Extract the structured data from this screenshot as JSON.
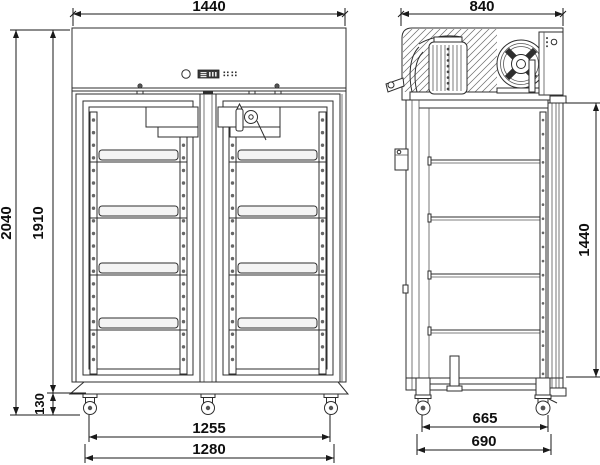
{
  "dimensions": {
    "front_width": "1440",
    "side_depth": "840",
    "overall_height": "2040",
    "body_height": "1910",
    "caster_height": "130",
    "front_caster_span": "1255",
    "front_base_width": "1280",
    "side_door_height": "1440",
    "side_caster_span": "665",
    "side_base_depth": "690"
  },
  "colors": {
    "line": "#2e2e2e",
    "dimension_line": "#1a1a1a",
    "text": "#0f0f0f",
    "background": "#ffffff",
    "display_fill": "#3a3a3a"
  }
}
